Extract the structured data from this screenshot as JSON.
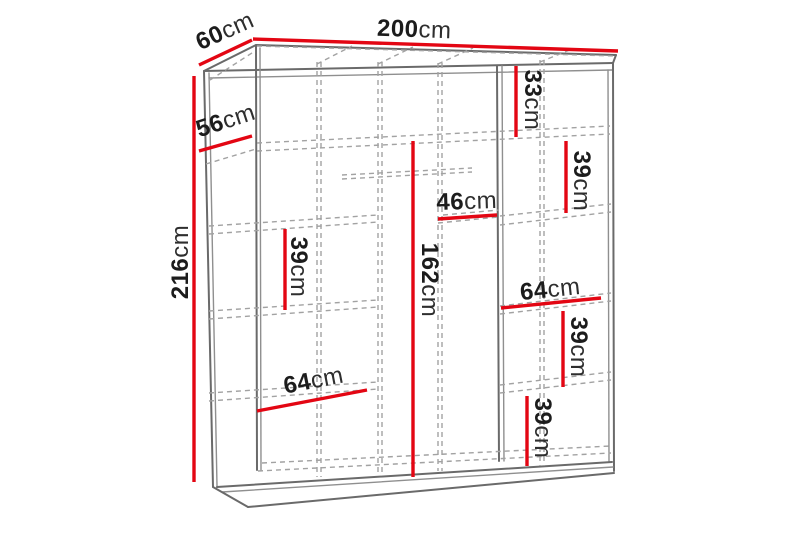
{
  "diagram": {
    "kind": "wardrobe-dimension-diagram",
    "description": "Front 3/4 line drawing of a 200cm sliding-door wardrobe with interior shelf layout and red dimension lines",
    "unit": "cm"
  },
  "colors": {
    "accent": "#e30613",
    "ink": "#1c1c1c",
    "line": "#6a6a6a",
    "line2": "#8f8f8f",
    "dash": "#a2a2a2",
    "background": "#ffffff"
  },
  "labels": {
    "width_top": {
      "value": "200",
      "unit": "cm"
    },
    "depth_top": {
      "value": "60",
      "unit": "cm"
    },
    "height_left": {
      "value": "216",
      "unit": "cm"
    },
    "top_shelf_depth": {
      "value": "56",
      "unit": "cm"
    },
    "right_top_section": {
      "value": "33",
      "unit": "cm"
    },
    "right_upper_section": {
      "value": "39",
      "unit": "cm"
    },
    "middle_shelf_width": {
      "value": "46",
      "unit": "cm"
    },
    "hanging_space_height": {
      "value": "162",
      "unit": "cm"
    },
    "left_shelf_gap": {
      "value": "39",
      "unit": "cm"
    },
    "left_bottom_shelf": {
      "value": "64",
      "unit": "cm"
    },
    "right_shelf_width": {
      "value": "64",
      "unit": "cm"
    },
    "right_middle_section": {
      "value": "39",
      "unit": "cm"
    },
    "right_bottom_section": {
      "value": "39",
      "unit": "cm"
    }
  }
}
